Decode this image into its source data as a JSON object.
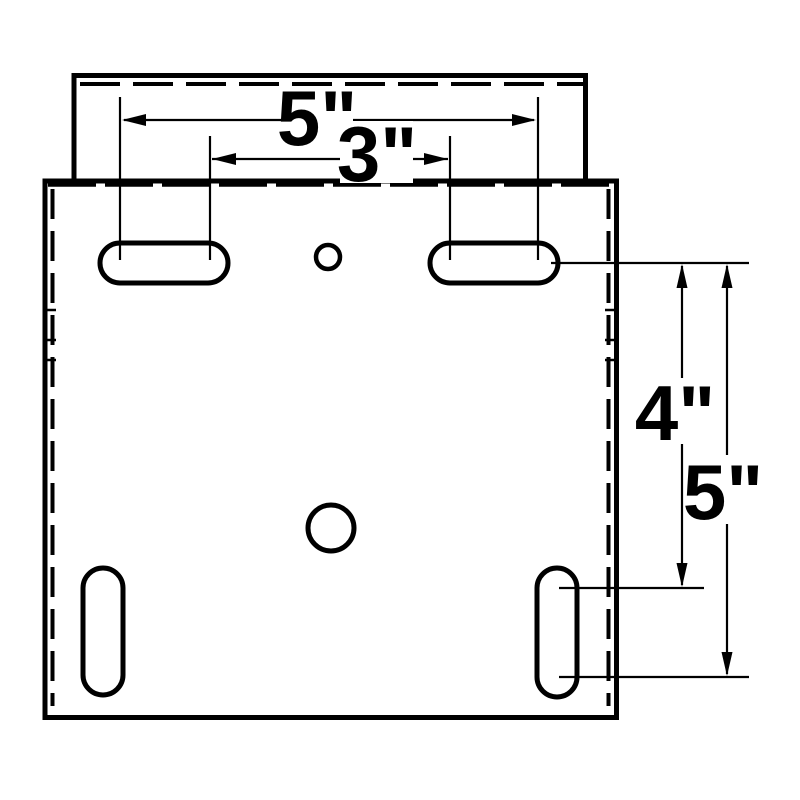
{
  "page": {
    "background_color": "#ffffff",
    "line_color": "#000000"
  },
  "drawing": {
    "kind": "technical-dimension-drawing",
    "subject": "mounting bracket plate with top flange, slotted holes and center hole",
    "dimensions": [
      {
        "id": "top-slot-outer-spacing",
        "label": "5\"",
        "value": 5,
        "unit": "inch",
        "orientation": "horizontal"
      },
      {
        "id": "top-slot-inner-spacing",
        "label": "3\"",
        "value": 3,
        "unit": "inch",
        "orientation": "horizontal"
      },
      {
        "id": "side-slot-upper-offset",
        "label": "4\"",
        "value": 4,
        "unit": "inch",
        "orientation": "vertical"
      },
      {
        "id": "side-slot-lower-offset",
        "label": "5\"",
        "value": 5,
        "unit": "inch",
        "orientation": "vertical"
      }
    ],
    "features": {
      "top_horizontal_slots": 2,
      "bottom_vertical_slots": 2,
      "small_pilot_hole": 1,
      "center_hole": 1,
      "hidden_edge_style": "dashed"
    }
  }
}
